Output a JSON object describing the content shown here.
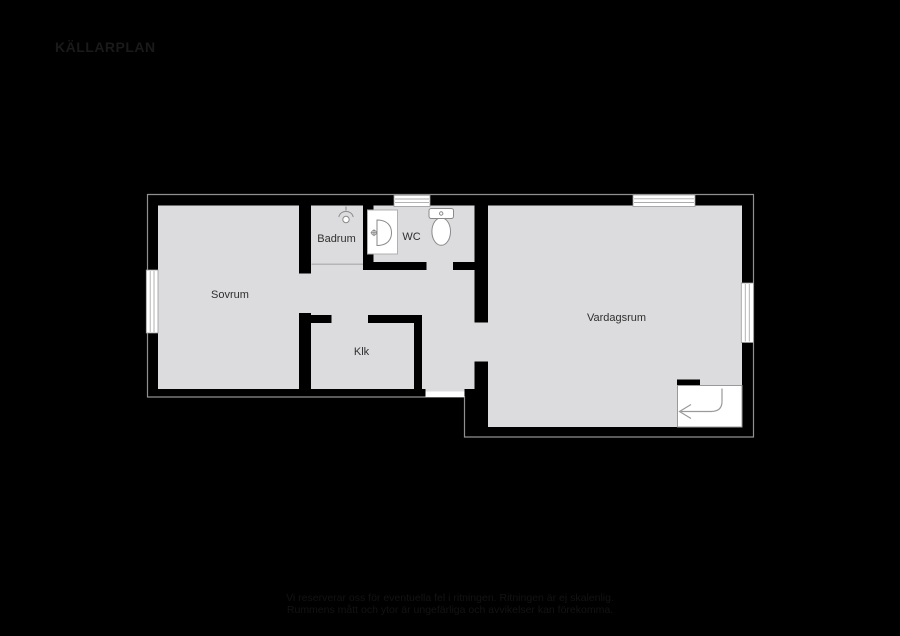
{
  "title": "KÄLLARPLAN",
  "floorplan": {
    "rooms": {
      "sovrum": {
        "label": "Sovrum"
      },
      "badrum": {
        "label": "Badrum"
      },
      "wc": {
        "label": "WC"
      },
      "klk": {
        "label": "Klk"
      },
      "vardagsrum": {
        "label": "Vardagsrum"
      }
    },
    "icons": [
      "shower-icon",
      "sink-icon",
      "toilet-icon",
      "stairs-direction-arrow-icon"
    ],
    "colors": {
      "background": "#000000",
      "floor": "#dcdcde",
      "wall": "#000000",
      "wall_outline": "#909090",
      "window_fill": "#ffffff",
      "fixture_stroke": "#8a8a8a",
      "label_text": "#2f2f2f",
      "title_text": "#1a1a1a",
      "footer_text": "#131313"
    }
  },
  "footer": {
    "line1": "Vi reserverar oss för eventuella fel i ritningen. Ritningen är ej skalenlig.",
    "line2": "Rummens mått och ytor är ungefärliga och avvikelser kan förekomma."
  }
}
